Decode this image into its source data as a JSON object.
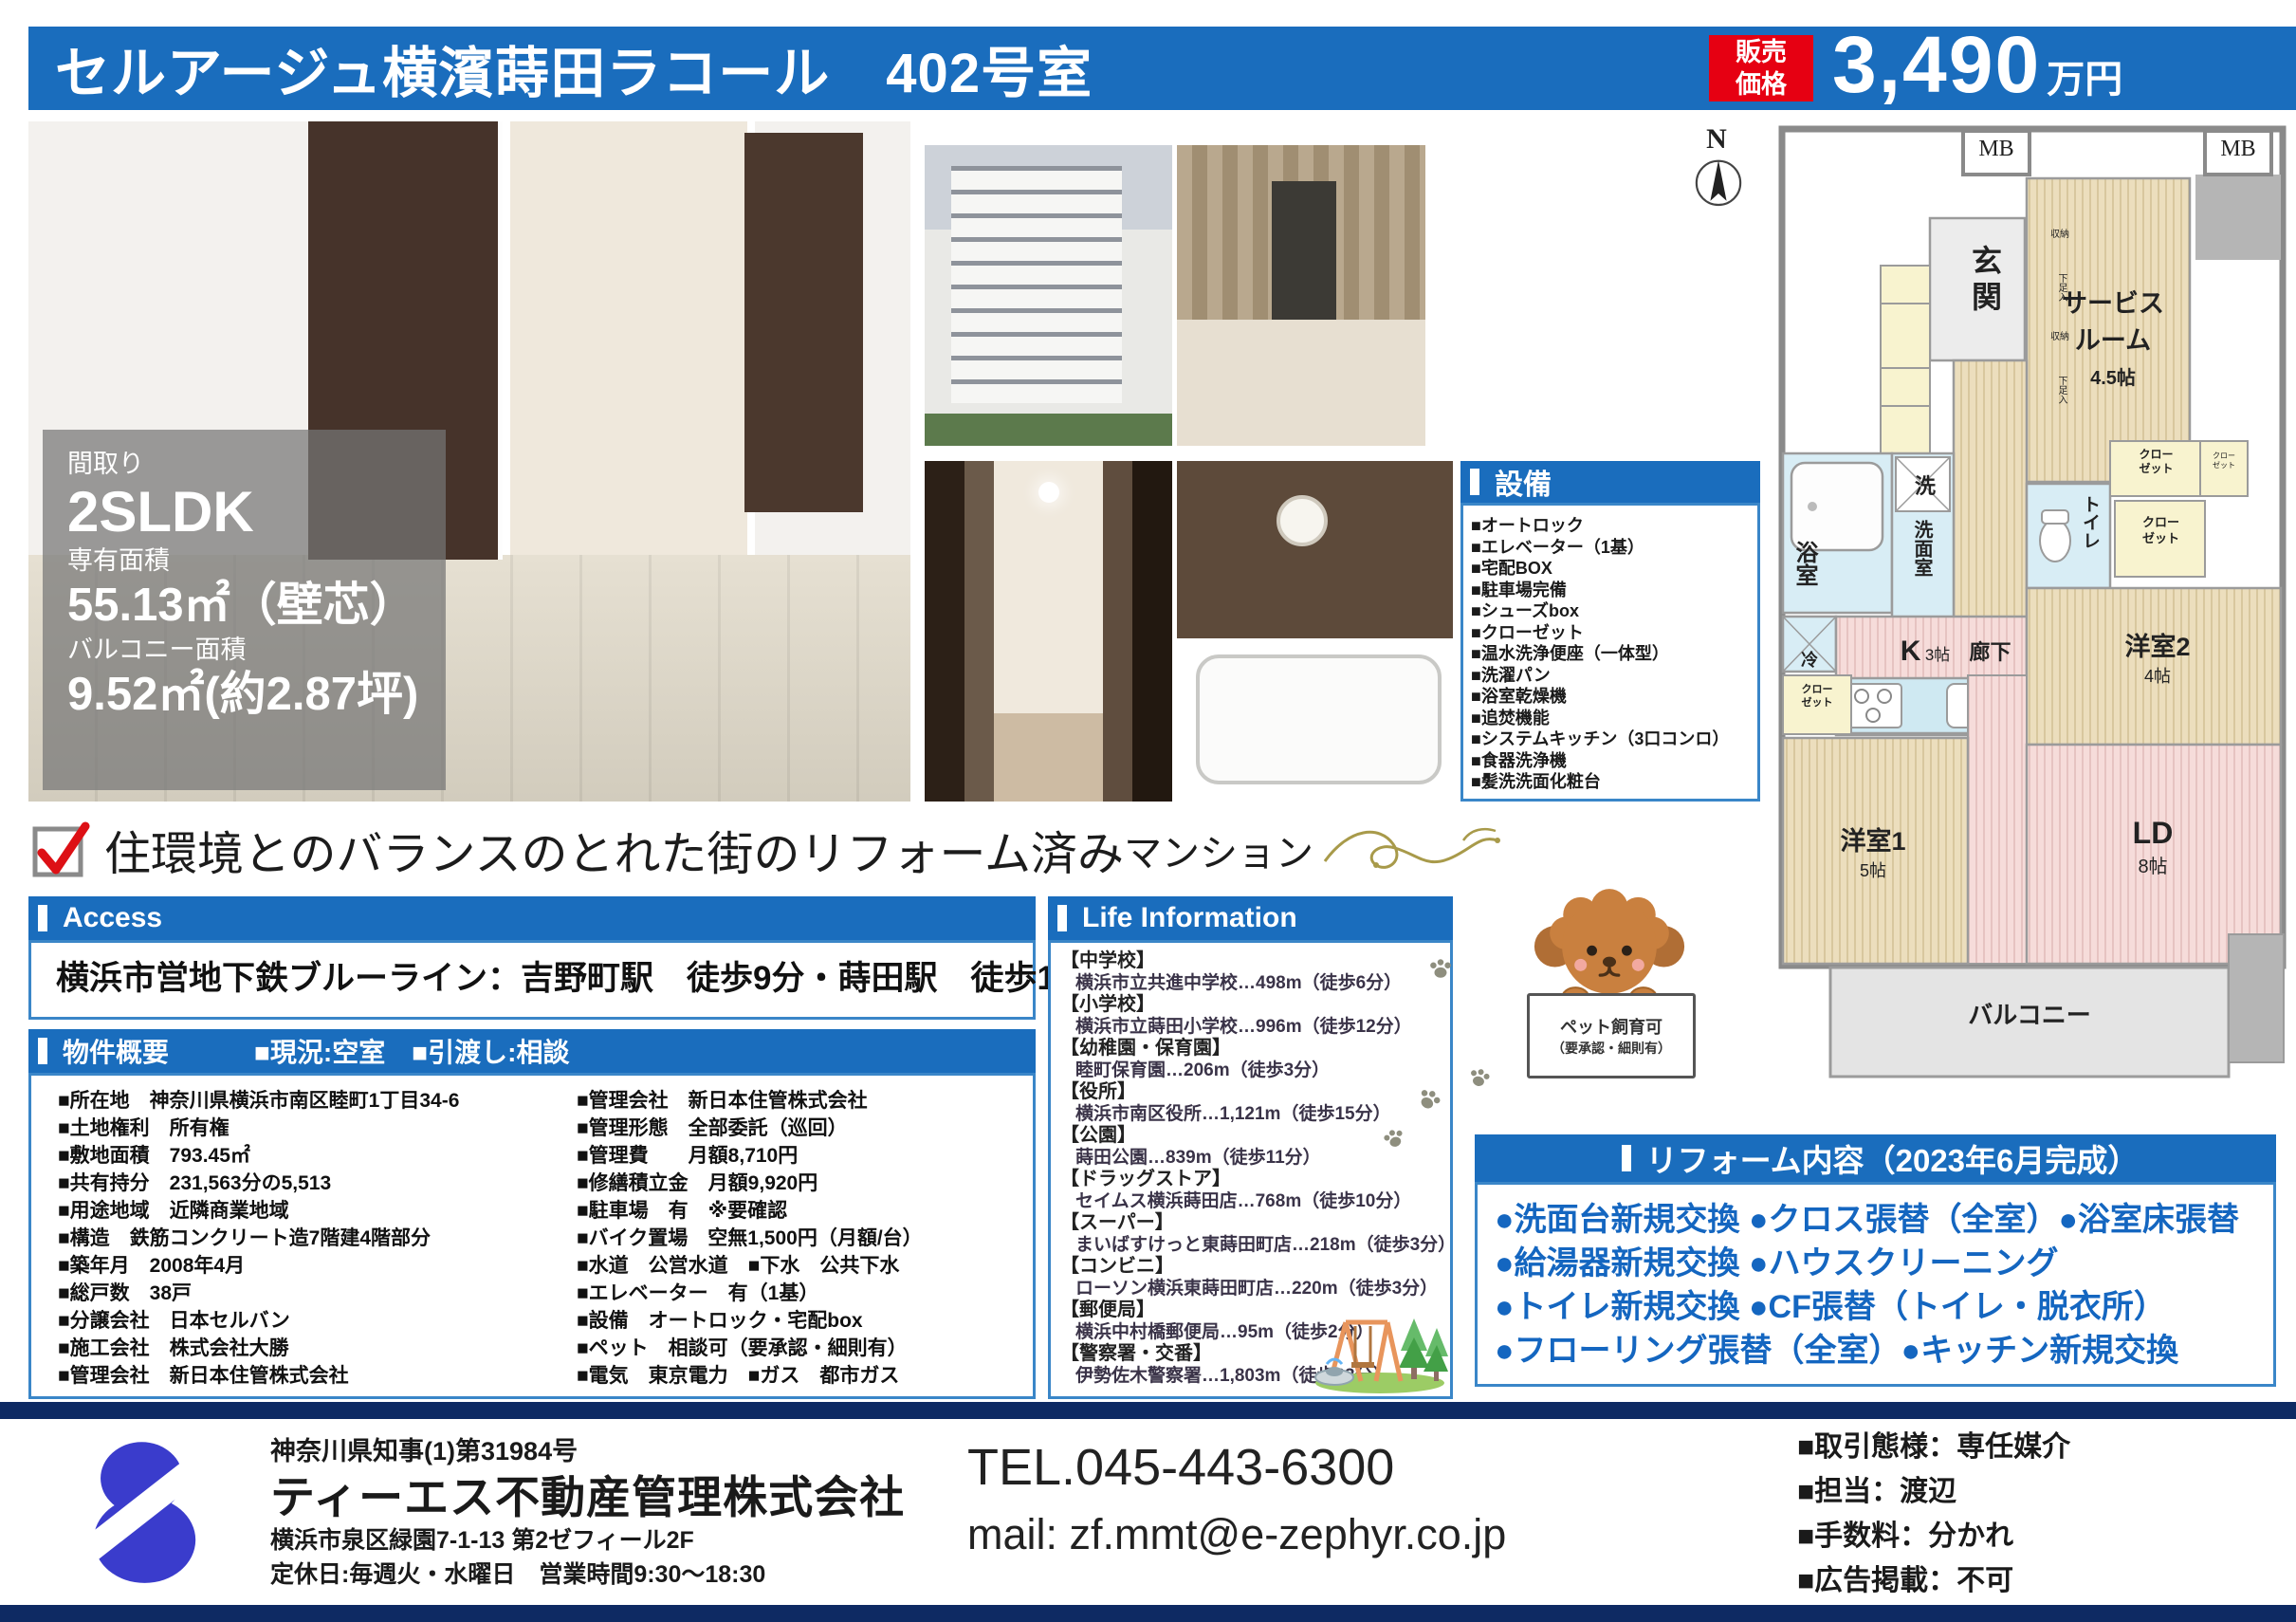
{
  "colors": {
    "accent_blue": "#1a6dbd",
    "price_red": "#e60012",
    "navy_band": "#0e2a63",
    "reform_text": "#1466c0",
    "logo_blue": "#3a3ccc"
  },
  "header": {
    "title": "セルアージュ横濱蒔田ラコール　402号室",
    "price_tag_1": "販売",
    "price_tag_2": "価格",
    "price_value": "3,490",
    "price_unit": "万円"
  },
  "overlay": {
    "madori_label": "間取り",
    "madori": "2SLDK",
    "area_label": "専有面積",
    "area": "55.13㎡（壁芯）",
    "balcony_label": "バルコニー面積",
    "balcony": "9.52㎡(約2.87坪)"
  },
  "equipment": {
    "title": "設備",
    "items": [
      "■オートロック",
      "■エレベーター（1基）",
      "■宅配BOX",
      "■駐車場完備",
      "■シューズbox",
      "■クローゼット",
      "■温水洗浄便座（一体型）",
      "■洗濯パン",
      "■浴室乾燥機",
      "■追焚機能",
      "■システムキッチン（3口コンロ）",
      "■食器洗浄機",
      "■髪洗洗面化粧台"
    ]
  },
  "headline": {
    "main": "住環境とのバランスのとれた街のリフォーム済み",
    "suffix": "マンション"
  },
  "access": {
    "title": "Access",
    "text": "横浜市営地下鉄ブルーライン：吉野町駅　徒歩9分・蒔田駅　徒歩10分"
  },
  "overview": {
    "title": "物件概要",
    "status": "■現況:空室　■引渡し:相談",
    "left": [
      "■所在地　神奈川県横浜市南区睦町1丁目34-6",
      "■土地権利　所有権",
      "■敷地面積　793.45㎡",
      "■共有持分　231,563分の5,513",
      "■用途地域　近隣商業地域",
      "■構造　鉄筋コンクリート造7階建4階部分",
      "■築年月　2008年4月",
      "■総戸数　38戸",
      "■分譲会社　日本セルバン",
      "■施工会社　株式会社大勝",
      "■管理会社　新日本住管株式会社"
    ],
    "right": [
      "■管理会社　新日本住管株式会社",
      "■管理形態　全部委託（巡回）",
      "■管理費　　月額8,710円",
      "■修繕積立金　月額9,920円",
      "■駐車場　有　※要確認",
      "■バイク置場　空無1,500円（月額/台）",
      "■水道　公営水道　■下水　公共下水",
      "■エレベーター　有（1基）",
      "■設備　オートロック・宅配box",
      "■ペット　相談可（要承認・細則有）",
      "■電気　東京電力　■ガス　都市ガス"
    ]
  },
  "life": {
    "title": "Life Information",
    "entries": [
      {
        "c": "【中学校】",
        "d": "横浜市立共進中学校…498m（徒歩6分）"
      },
      {
        "c": "【小学校】",
        "d": "横浜市立蒔田小学校…996m（徒歩12分）"
      },
      {
        "c": "【幼稚園・保育園】",
        "d": "睦町保育園…206m（徒歩3分）"
      },
      {
        "c": "【役所】",
        "d": "横浜市南区役所…1,121m（徒歩15分）"
      },
      {
        "c": "【公園】",
        "d": "蒔田公園…839m（徒歩11分）"
      },
      {
        "c": "【ドラッグストア】",
        "d": "セイムス横浜蒔田店…768m（徒歩10分）"
      },
      {
        "c": "【スーパー】",
        "d": "まいばすけっと東蒔田町店…218m（徒歩3分）"
      },
      {
        "c": "【コンビニ】",
        "d": "ローソン横浜東蒔田町店…220m（徒歩3分）"
      },
      {
        "c": "【郵便局】",
        "d": "横浜中村橋郵便局…95m（徒歩2分）"
      },
      {
        "c": "【警察署・交番】",
        "d": "伊勢佐木警察署…1,803m（徒歩23分）"
      }
    ]
  },
  "pet": {
    "line1": "ペット飼育可",
    "line2": "（要承認・細則有）"
  },
  "reform": {
    "title": "リフォーム内容（2023年6月完成）",
    "lines": [
      "●洗面台新規交換 ●クロス張替（全室）●浴室床張替",
      "●給湯器新規交換 ●ハウスクリーニング",
      "●トイレ新規交換 ●CF張替（トイレ・脱衣所）",
      "●フローリング張替（全室）●キッチン新規交換"
    ]
  },
  "floorplan": {
    "compass": "N",
    "mb": "MB",
    "genkan": "玄関",
    "service_1": "サービス",
    "service_2": "ルーム",
    "service_size": "4.5帖",
    "shunou": "収納",
    "getabako": "下足入",
    "rouka": "廊下",
    "bath": "浴室",
    "sen": "洗",
    "senmenshitsu": "洗面室",
    "toilet": "トイレ",
    "closet": "クロー\nゼット",
    "rei": "冷",
    "k": "K",
    "k_size": "3帖",
    "yoshitsu2": "洋室2",
    "yoshitsu2_size": "4帖",
    "yoshitsu1": "洋室1",
    "yoshitsu1_size": "5帖",
    "ld": "LD",
    "ld_size": "8帖",
    "balcony": "バルコニー"
  },
  "footer": {
    "license": "神奈川県知事(1)第31984号",
    "company": "ティーエス不動産管理株式会社",
    "address": "横浜市泉区緑園7-1-13 第2ゼフィール2F",
    "hours": "定休日:毎週火・水曜日　営業時間9:30～18:30",
    "tel": "TEL.045-443-6300",
    "mail": "mail: zf.mmt@e-zephyr.co.jp",
    "notes": [
      "■取引態様：専任媒介",
      "■担当：渡辺",
      "■手数料：分かれ",
      "■広告掲載：不可"
    ]
  }
}
